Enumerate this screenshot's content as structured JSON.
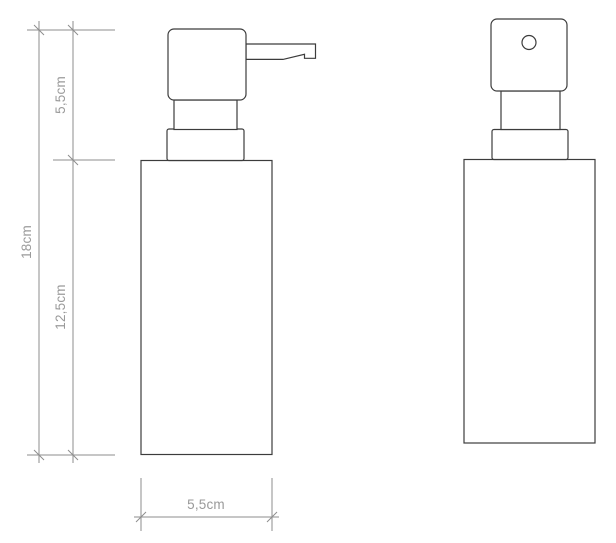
{
  "colors": {
    "object_line": "#3c3c3c",
    "dimension_line": "#8e8e8e",
    "label_text": "#9a9a9a",
    "background": "#ffffff"
  },
  "drawing": {
    "type": "technical-drawing",
    "subject": "soap-dispenser-two-views",
    "dimension_labels": {
      "pump_section_height": "5,5cm",
      "body_section_height": "12,5cm",
      "total_height": "18cm",
      "body_width": "5,5cm"
    }
  }
}
